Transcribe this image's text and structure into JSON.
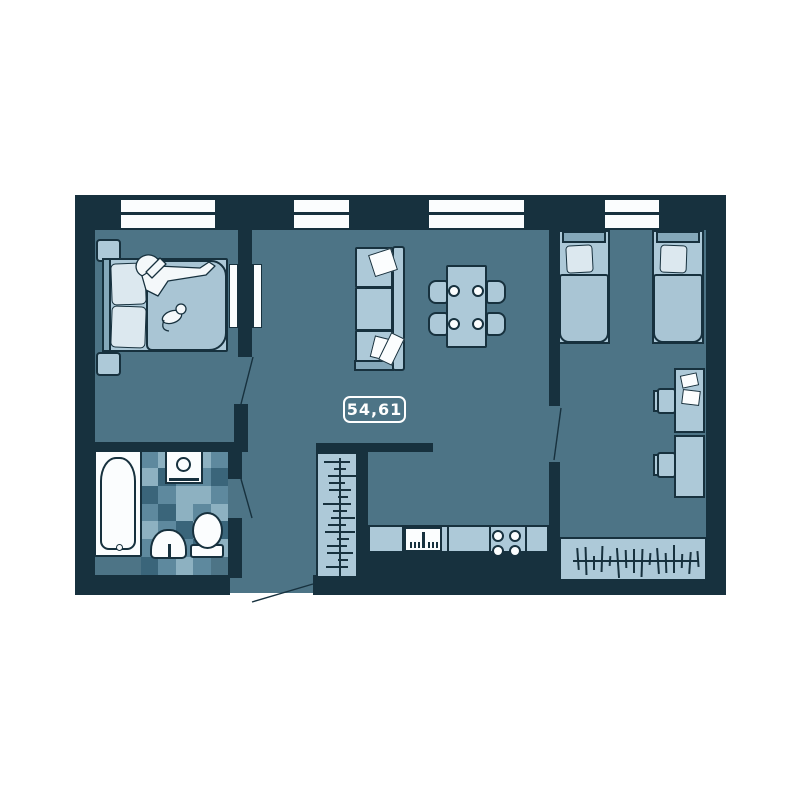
{
  "area_label": {
    "value": "54,61"
  },
  "colors": {
    "background": "#ffffff",
    "wall": "#17313e",
    "floor": "#4d7486",
    "furniture_light": "#adc9d8",
    "furniture_soft": "#a9c5d4",
    "furniture_lighter": "#dce8ef",
    "furniture_medium": "#85a8ba",
    "white": "#fbfdfe",
    "tile_light": "#8db1c1",
    "tile_medium": "#5e899e",
    "tile_dark": "#3a657a"
  },
  "windows": {
    "count": 4
  },
  "bathroom": {
    "tiles": [
      [
        "M",
        "L",
        "F",
        "L",
        "M"
      ],
      [
        "L",
        "D",
        "M",
        "M",
        "D"
      ],
      [
        "D",
        "M",
        "L",
        "L",
        "M"
      ],
      [
        "M",
        "D",
        "L",
        "M",
        "L"
      ],
      [
        "L",
        "M",
        "D",
        "L",
        "D"
      ],
      [
        "M",
        "L",
        "M",
        "D",
        "L"
      ],
      [
        "D",
        "M",
        "L",
        "M",
        "F"
      ]
    ]
  },
  "furniture": [
    "double-bed",
    "nightstand",
    "nightstand",
    "sofa",
    "dining-table",
    "dining-chair",
    "dining-chair",
    "dining-chair",
    "dining-chair",
    "single-bed",
    "single-bed",
    "desk",
    "desk",
    "desk-chair",
    "desk-chair",
    "wardrobe-hall",
    "wardrobe-bedroom",
    "kitchen-counter",
    "kitchen-sink",
    "stove",
    "bathtub",
    "washing-machine",
    "bathroom-sink",
    "toilet"
  ]
}
